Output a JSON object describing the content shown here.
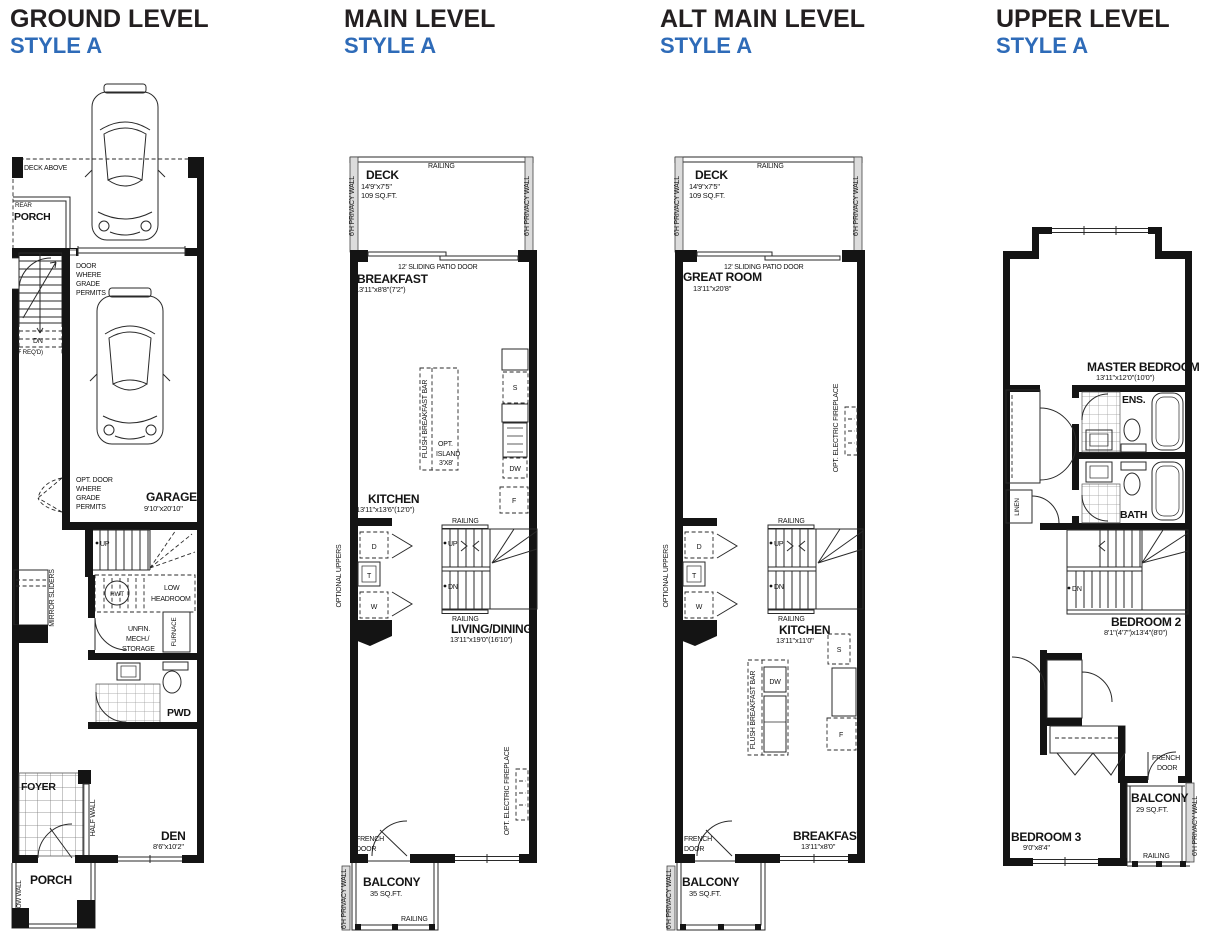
{
  "colors": {
    "accent": "#2e6bb8",
    "ink": "#231f20",
    "wall": "#141414",
    "privacy_wall": "#dcdcdc"
  },
  "plans": [
    {
      "name": "ground",
      "title": "GROUND LEVEL",
      "style": "STYLE A",
      "labels": {
        "deck_above": "DECK ABOVE",
        "rear": "REAR",
        "porch_top": "PORCH",
        "door_grade": [
          "DOOR",
          "WHERE",
          "GRADE",
          "PERMITS"
        ],
        "dn": "DN",
        "if_reqd": "(IF REQ'D)",
        "opt_door_grade": [
          "OPT. DOOR",
          "WHERE",
          "GRADE",
          "PERMITS"
        ],
        "garage": "GARAGE",
        "garage_dim": "9'10\"x20'10\"",
        "up": "UP",
        "hwt": "HWT",
        "low_headroom": [
          "LOW",
          "HEADROOM"
        ],
        "mirror_sliders": "MIRROR SLIDERS",
        "unfin": [
          "UNFIN.",
          "MECH./",
          "STORAGE"
        ],
        "furnace": "FURNACE",
        "pwd": "PWD",
        "foyer": "FOYER",
        "half_wall": "HALF WALL",
        "den": "DEN",
        "den_dim": "8'6\"x10'2\"",
        "porch": "PORCH",
        "low_wall": "LOW WALL"
      }
    },
    {
      "name": "main",
      "title": "MAIN LEVEL",
      "style": "STYLE A",
      "labels": {
        "railing_top": "RAILING",
        "deck": "DECK",
        "deck_dim": "14'9\"x7'5\"",
        "deck_sqft": "109 SQ.FT.",
        "privacy_left": "6'H PRIVACY WALL",
        "privacy_right": "6'H PRIVACY WALL",
        "patio_door": "12' SLIDING PATIO DOOR",
        "breakfast": "BREAKFAST",
        "breakfast_dim": "13'11\"x8'8\"(7'2\")",
        "flush_bar": "FLUSH BREAKFAST BAR",
        "opt_island": [
          "OPT.",
          "ISLAND",
          "3'X8'"
        ],
        "s": "S",
        "dw": "DW",
        "f": "F",
        "kitchen": "KITCHEN",
        "kitchen_dim": "13'11\"x13'6\"(12'0\")",
        "optional_uppers": "OPTIONAL UPPERS",
        "d": "D",
        "t": "T",
        "w": "W",
        "railing_stair_top": "RAILING",
        "up": "UP",
        "dn": "DN",
        "railing_stair_bottom": "RAILING",
        "living": "LIVING/DINING",
        "living_dim": "13'11\"x19'0\"(16'10\")",
        "opt_fireplace": "OPT. ELECTRIC FIREPLACE",
        "french_door": [
          "FRENCH",
          "DOOR"
        ],
        "balcony": "BALCONY",
        "balcony_sqft": "35 SQ.FT.",
        "railing_balcony": "RAILING",
        "privacy_balcony": "6'H PRIVACY WALL"
      }
    },
    {
      "name": "alt-main",
      "title": "ALT MAIN LEVEL",
      "style": "STYLE A",
      "labels": {
        "railing_top": "RAILING",
        "deck": "DECK",
        "deck_dim": "14'9\"x7'5\"",
        "deck_sqft": "109 SQ.FT.",
        "privacy_left": "6'H PRIVACY WALL",
        "privacy_right": "6'H PRIVACY WALL",
        "patio_door": "12' SLIDING PATIO DOOR",
        "great_room": "GREAT ROOM",
        "great_room_dim": "13'11\"x20'8\"",
        "opt_fireplace": "OPT. ELECTRIC FIREPLACE",
        "optional_uppers": "OPTIONAL UPPERS",
        "d": "D",
        "t": "T",
        "w": "W",
        "railing_stair_top": "RAILING",
        "up": "UP",
        "dn": "DN",
        "railing_stair_bottom": "RAILING",
        "kitchen": "KITCHEN",
        "kitchen_dim": "13'11\"x11'0\"",
        "flush_bar": "FLUSH BREAKFAST BAR",
        "s": "S",
        "dw": "DW",
        "f": "F",
        "french_door": [
          "FRENCH",
          "DOOR"
        ],
        "breakfast": "BREAKFAST",
        "breakfast_dim": "13'11\"x8'0\"",
        "balcony": "BALCONY",
        "balcony_sqft": "35 SQ.FT.",
        "privacy_balcony": "6'H PRIVACY WALL"
      }
    },
    {
      "name": "upper",
      "title": "UPPER LEVEL",
      "style": "STYLE A",
      "labels": {
        "master": "MASTER BEDROOM",
        "master_dim": "13'11\"x12'0\"(10'0\")",
        "ens": "ENS.",
        "bath": "BATH",
        "linen": "LINEN",
        "dn": "DN",
        "bedroom2": "BEDROOM 2",
        "bedroom2_dim": "8'1\"(4'7\")x13'4\"(8'0\")",
        "french_door": [
          "FRENCH",
          "DOOR"
        ],
        "balcony": "BALCONY",
        "balcony_sqft": "29 SQ.FT.",
        "railing_balcony": "RAILING",
        "privacy_right": "6'H PRIVACY WALL",
        "bedroom3": "BEDROOM 3",
        "bedroom3_dim": "9'0\"x8'4\""
      }
    }
  ]
}
